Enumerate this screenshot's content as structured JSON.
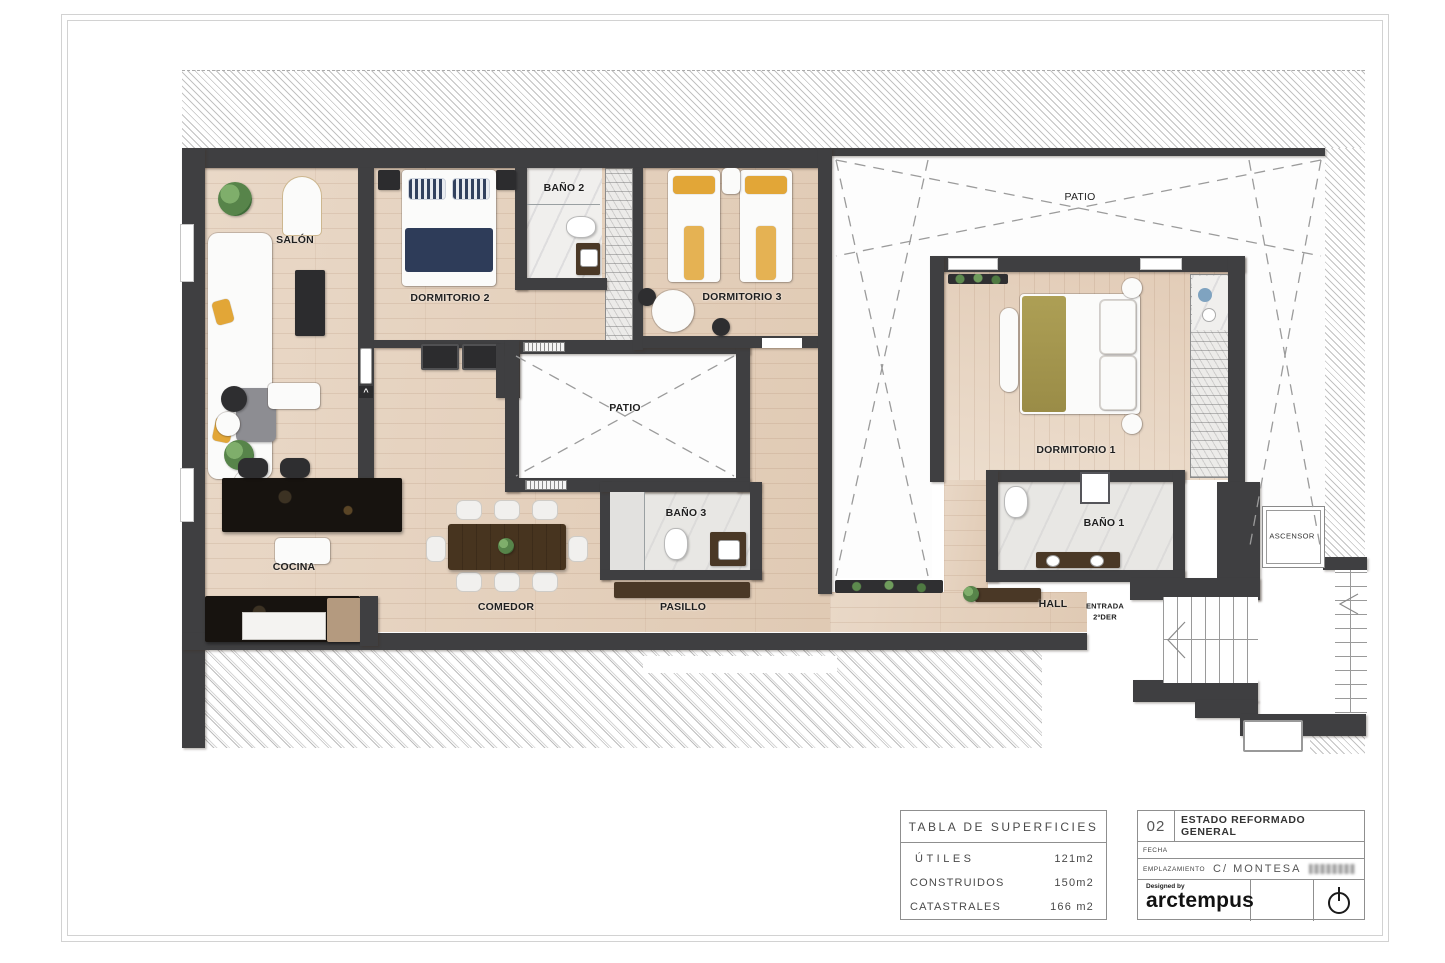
{
  "palette": {
    "wall": "#3f3f41",
    "wood_floor": "#e5d1be",
    "tile_floor": "#efeeec",
    "patio_white": "#fdfdfd",
    "accent_yellow": "#e2a637",
    "accent_navy": "#2e3c59",
    "accent_olive": "#a79a50",
    "dashed_line": "#9b9b9b",
    "frame_line": "#d2d2d2"
  },
  "plan": {
    "labels": [
      "SALÓN",
      "DORMITORIO 2",
      "BAÑO 2",
      "DORMITORIO 3",
      "PATIO",
      "PATIO",
      "DORMITORIO 1",
      "BAÑO 1",
      "COCINA",
      "COMEDOR",
      "PASILLO",
      "BAÑO 3",
      "HALL",
      "ENTRADA",
      "2ºDER",
      "ASCENSOR"
    ]
  },
  "surfaces_table": {
    "title": "TABLA DE SUPERFICIES",
    "rows": [
      {
        "label": "ÚTILES",
        "value": "121m2"
      },
      {
        "label": "CONSTRUIDOS",
        "value": "150m2"
      },
      {
        "label": "CATASTRALES",
        "value": "166 m2"
      }
    ]
  },
  "title_block": {
    "sheet_number": "02",
    "sheet_title": "ESTADO REFORMADO GENERAL",
    "fecha_label": "FECHA",
    "emplazamiento_label": "EMPLAZAMIENTO",
    "emplazamiento_value": "C/ MONTESA",
    "designed_by_label": "Designed by",
    "brand_name": "arctempus"
  }
}
